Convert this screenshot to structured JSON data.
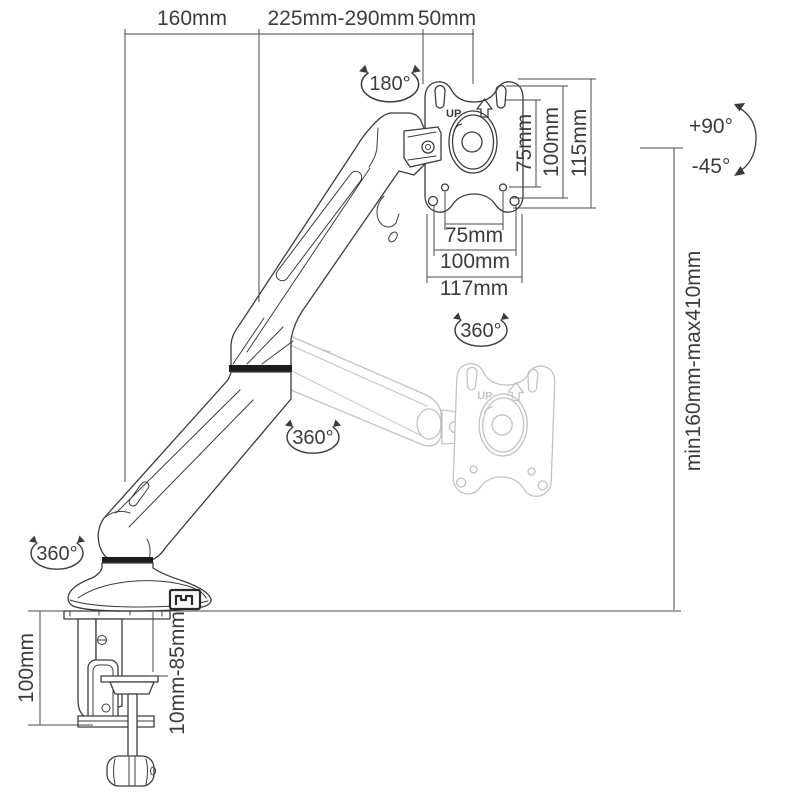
{
  "meta": {
    "description": "Gas-spring desk-clamp monitor arm dimension diagram"
  },
  "colors": {
    "ink": "#3c3c3c",
    "ghost": "#c2c2c2",
    "background": "#ffffff",
    "joint_band": "#1c1c1c"
  },
  "top_dimensions": {
    "rear_offset": "160mm",
    "arm_reach": "225mm-290mm",
    "head_offset": "50mm"
  },
  "vesa_plate": {
    "up_label": "UP",
    "ghost_up_label": "UP",
    "vertical": {
      "v75": "75mm",
      "v100": "100mm",
      "v115": "115mm"
    },
    "horizontal": {
      "h75": "75mm",
      "h100": "100mm",
      "h117": "117mm"
    }
  },
  "rotations": {
    "head_swivel": "180°",
    "plate_rotation": "360°",
    "arm_swivel": "360°",
    "base_swivel": "360°",
    "tilt_up": "+90°",
    "tilt_down": "-45°"
  },
  "height_range": {
    "label": "min160mm-max410mm"
  },
  "clamp": {
    "throat_depth": "100mm",
    "desk_thickness": "10mm-85mm"
  }
}
